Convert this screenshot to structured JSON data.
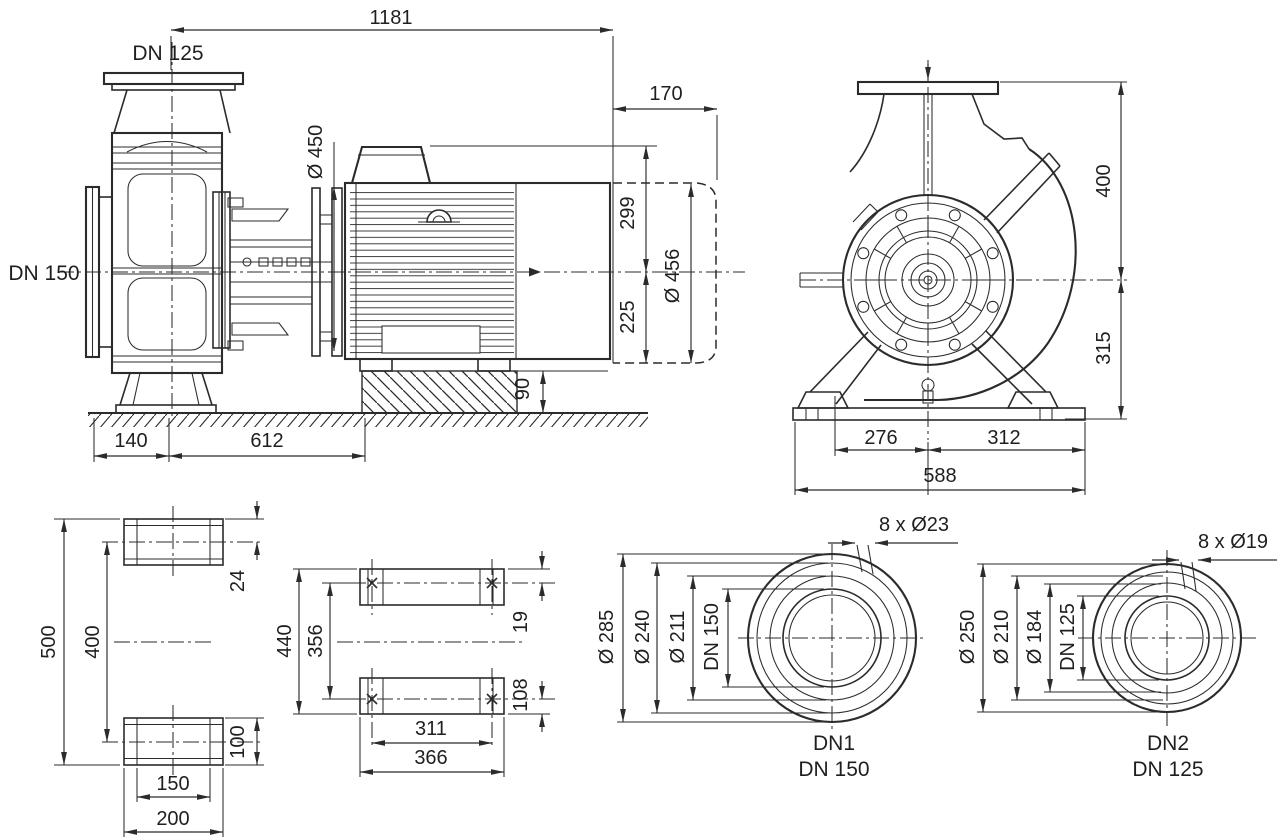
{
  "drawing": {
    "type": "pump-dimensional-drawing",
    "colors": {
      "line": "#2b2b2b",
      "text": "#1f1f1f",
      "background": "#ffffff"
    },
    "side_view": {
      "discharge_label": "DN 125",
      "suction_label": "DN 150",
      "total_length": "1181",
      "motor_extension": "170",
      "motor_flange_dia": "Ø 450",
      "center_to_top": "299",
      "center_to_base": "225",
      "fan_cowl_dia": "Ø 456",
      "foundation_height": "90",
      "flange_to_support": "140",
      "support_to_foundation": "612"
    },
    "end_view": {
      "flange_top_to_center": "400",
      "center_to_base": "315",
      "center_to_left_foot": "276",
      "center_to_right_edge": "312",
      "base_width": "588"
    },
    "support_side_view": {
      "total_height": "500",
      "hole_centers": "400",
      "pad_top_offset": "24",
      "pad_height": "100",
      "slot_centers": "150",
      "pad_width": "200"
    },
    "support_plan_view": {
      "outer_length": "440",
      "hole_centers_long": "356",
      "hole_offset_top": "19",
      "hole_offset_bottom": "108",
      "hole_centers_wide": "311",
      "outer_width": "366"
    },
    "flange_dn1": {
      "bolt_holes": "8 x Ø23",
      "outer_dia": "Ø 285",
      "bolt_circle_dia": "Ø 240",
      "raised_face_dia": "Ø 211",
      "nominal_bore": "DN 150",
      "port_id": "DN1",
      "port_size": "DN 150"
    },
    "flange_dn2": {
      "bolt_holes": "8 x Ø19",
      "outer_dia": "Ø 250",
      "bolt_circle_dia": "Ø 210",
      "raised_face_dia": "Ø 184",
      "nominal_bore": "DN 125",
      "port_id": "DN2",
      "port_size": "DN 125"
    }
  }
}
